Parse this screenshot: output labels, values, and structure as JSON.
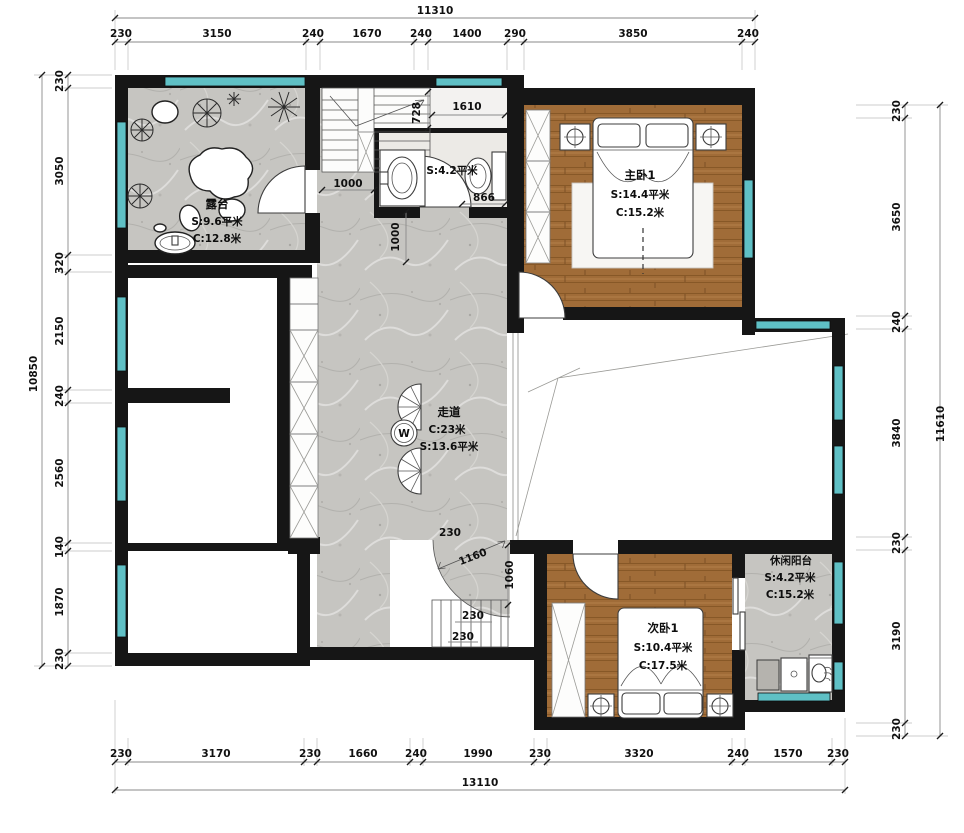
{
  "plan_type": "residential-floor-plan",
  "dims": {
    "top": {
      "total": "11310",
      "segs": [
        "230",
        "3150",
        "240",
        "1670",
        "240",
        "1400",
        "290",
        "3850",
        "240"
      ]
    },
    "left": {
      "total": "10850",
      "segs": [
        "230",
        "3050",
        "320",
        "2150",
        "240",
        "2560",
        "140",
        "1870",
        "230"
      ]
    },
    "right": {
      "total": "11610",
      "segs": [
        "230",
        "3650",
        "240",
        "3840",
        "230",
        "3190",
        "230"
      ]
    },
    "bottom": {
      "total": "13110",
      "segs": [
        "230",
        "3170",
        "230",
        "1660",
        "240",
        "1990",
        "230",
        "3320",
        "240",
        "1570",
        "230"
      ]
    },
    "interior": {
      "d728": "728",
      "d1610": "1610",
      "d866": "866",
      "d1000a": "1000",
      "d1000b": "1000",
      "d230a": "230",
      "d1160": "1160",
      "d1060": "1060",
      "d230b": "230",
      "d230c": "230"
    }
  },
  "rooms": {
    "terrace": {
      "name": "露台",
      "area": "S:9.6平米",
      "perimeter": "C:12.8米"
    },
    "master_bedroom": {
      "name": "主卧1",
      "area": "S:14.4平米",
      "perimeter": "C:15.2米"
    },
    "corridor": {
      "name": "走道",
      "perimeter": "C:23米",
      "area": "S:13.6平米"
    },
    "second_bedroom": {
      "name": "次卧1",
      "area": "S:10.4平米",
      "perimeter": "C:17.5米"
    },
    "leisure_balcony": {
      "name": "休闲阳台",
      "area": "S:4.2平米",
      "perimeter": "C:15.2米"
    },
    "bathroom": {
      "area": "S:4.2平米"
    }
  },
  "symbols": {
    "floor_drain": "W"
  },
  "colors": {
    "wall": "#161616",
    "window": "#5fc0c5",
    "wood_floor": "#a06c38",
    "stone_floor": "#c6c5c1",
    "paper": "#ffffff"
  }
}
